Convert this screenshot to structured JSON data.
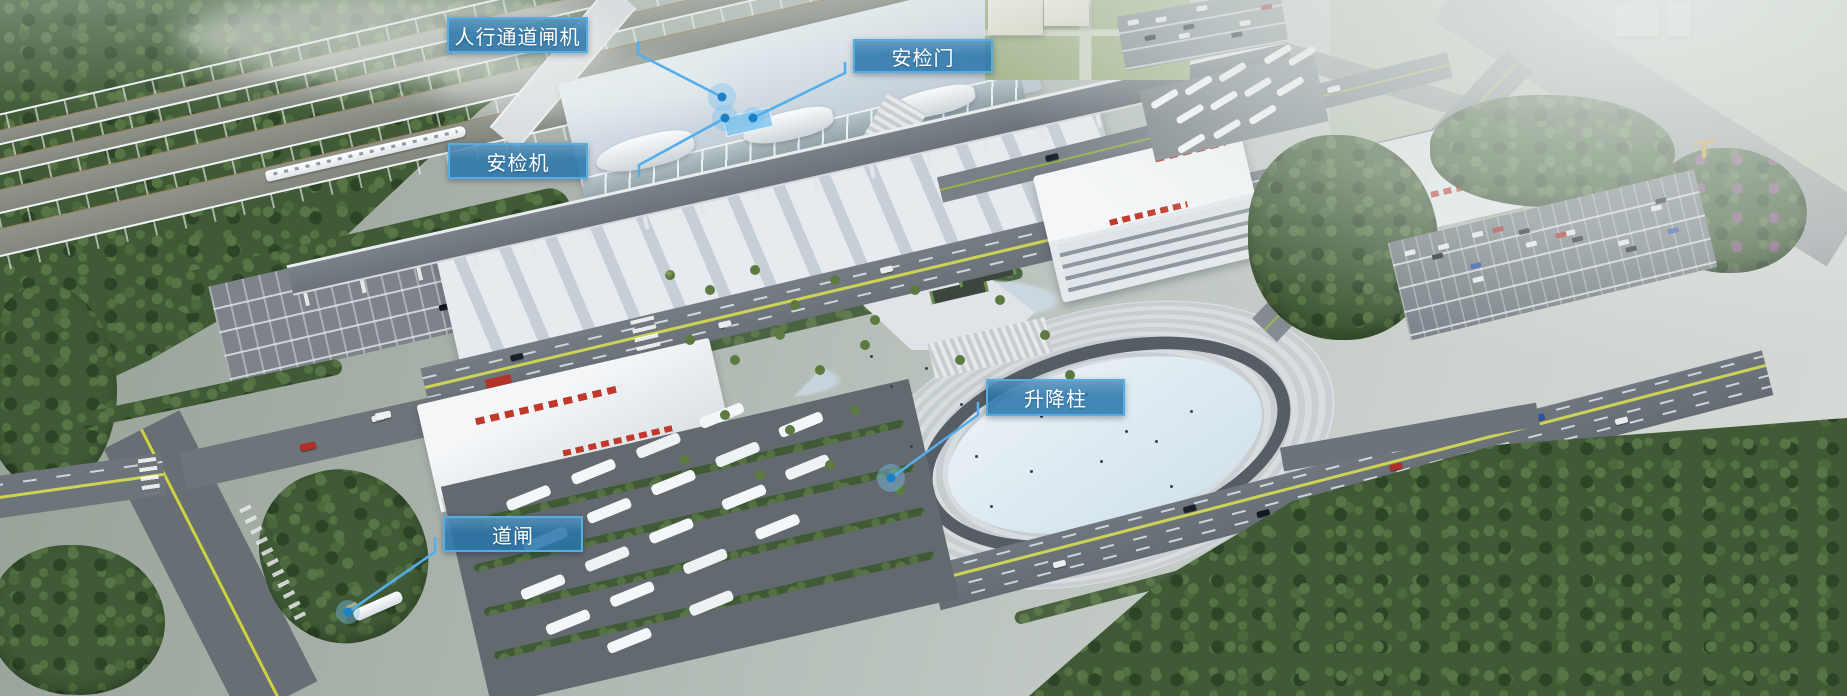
{
  "annotations": [
    {
      "id": "pedestrian-channel-gate",
      "label": "人行通道闸机",
      "box": {
        "x": 447,
        "y": 17,
        "w": 141,
        "h": 36
      },
      "leader": "638,41 638,54 722,97",
      "dot": {
        "x": 722,
        "y": 97,
        "r": 4.5,
        "halo": 14
      }
    },
    {
      "id": "security-door",
      "label": "安检门",
      "box": {
        "x": 853,
        "y": 39,
        "w": 140,
        "h": 34
      },
      "leader": "845,62 845,73 753,118",
      "dot": {
        "x": 753,
        "y": 118,
        "r": 4.5,
        "halo": 11
      }
    },
    {
      "id": "security-scanner",
      "label": "安检机",
      "box": {
        "x": 448,
        "y": 143,
        "w": 140,
        "h": 36
      },
      "leader": "639,177 639,165 725,118",
      "dot": {
        "x": 725,
        "y": 118,
        "r": 4.5,
        "halo": 13
      }
    },
    {
      "id": "lifting-bollard",
      "label": "升降柱",
      "box": {
        "x": 986,
        "y": 379,
        "w": 139,
        "h": 37
      },
      "leader": "978,402 978,415 891,478",
      "dot": {
        "x": 891,
        "y": 478,
        "r": 4.5,
        "halo": 14
      }
    },
    {
      "id": "road-barrier-gate",
      "label": "道闸",
      "box": {
        "x": 443,
        "y": 516,
        "w": 140,
        "h": 36
      },
      "leader": "435,537 435,552 348,612",
      "dot": {
        "x": 348,
        "y": 612,
        "r": 4.5,
        "halo": 12
      }
    }
  ],
  "style": {
    "label_bg": "rgba(41,118,171,0.86)",
    "label_border": "#57ace0",
    "label_text": "#ffffff",
    "leader": "#55aee9",
    "dot_core": "#1b80c8",
    "dot_halo": "rgba(125,195,240,0.42)"
  }
}
